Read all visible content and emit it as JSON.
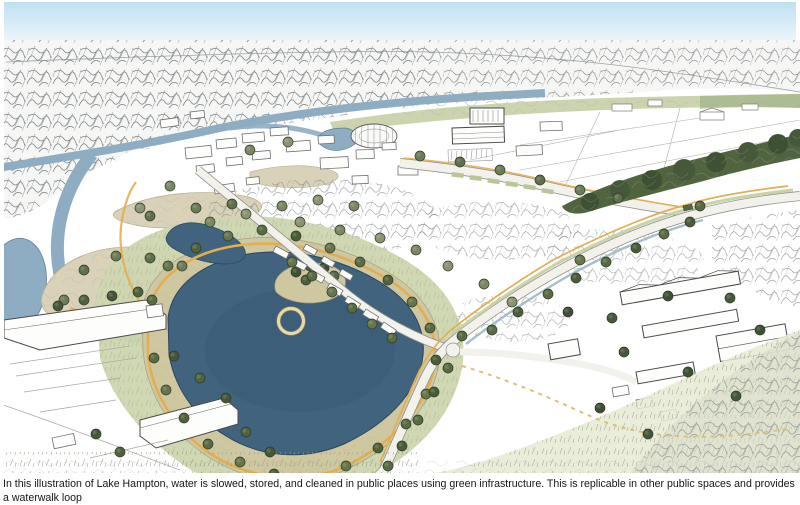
{
  "caption": {
    "lines": [
      "In this illustration of Lake Hampton, water is slowed, stored, and cleaned in public places using green infrastructure. This is replicable in other public spaces and provides a waterwalk loop",
      "and park for recreation. (Credit: Waggonner & Ball)"
    ],
    "credit": "Waggonner & Ball",
    "place_name": "Lake Hampton"
  },
  "palette": {
    "sky_top": "#bfe0f1",
    "sky_bottom": "#edf6fb",
    "lake": "#41637e",
    "lake_edge": "#2c485e",
    "river": "#8fadc2",
    "river_edge": "#5d829b",
    "sandbar": "#d9d2b8",
    "bank": "#cfc7a0",
    "park_green": "#cdd5af",
    "path_yellow": "#e3ae52",
    "boardwalk": "#e9d9a8",
    "dark_tree": "#3e5134",
    "ink": "#4a4a4a",
    "caption_color": "#161616"
  }
}
